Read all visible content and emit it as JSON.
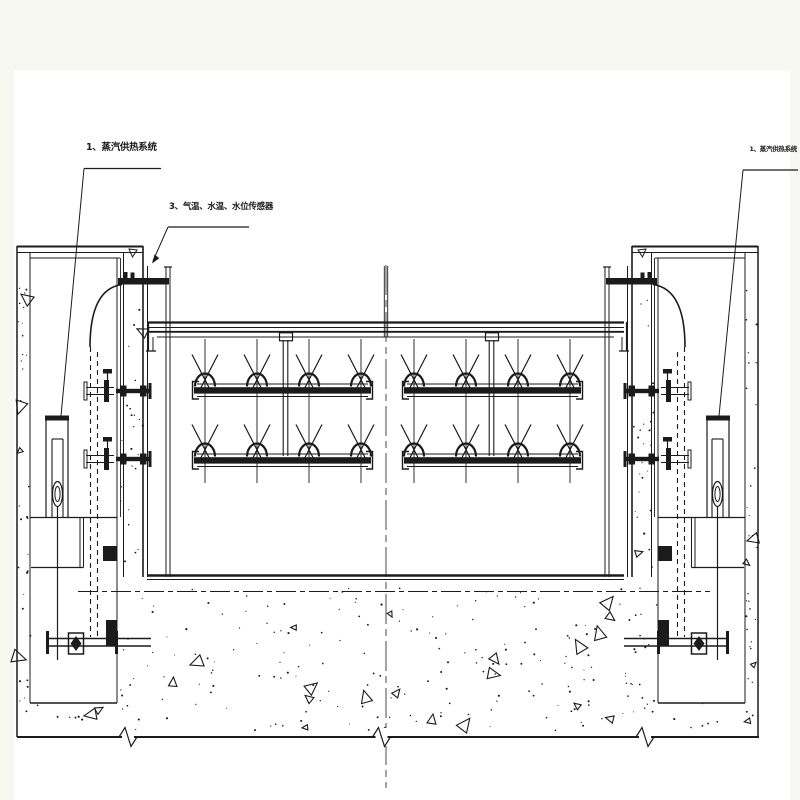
{
  "labels": {
    "steam_left": "1、蒸汽供热系统",
    "sensors": "3、气温、水温、水位传感器",
    "steam_right": "1、蒸汽供热系统"
  },
  "colors": {
    "ink": "#1b1b1b",
    "paper": "#ffffff",
    "margin_background": "#f6f8f1"
  }
}
